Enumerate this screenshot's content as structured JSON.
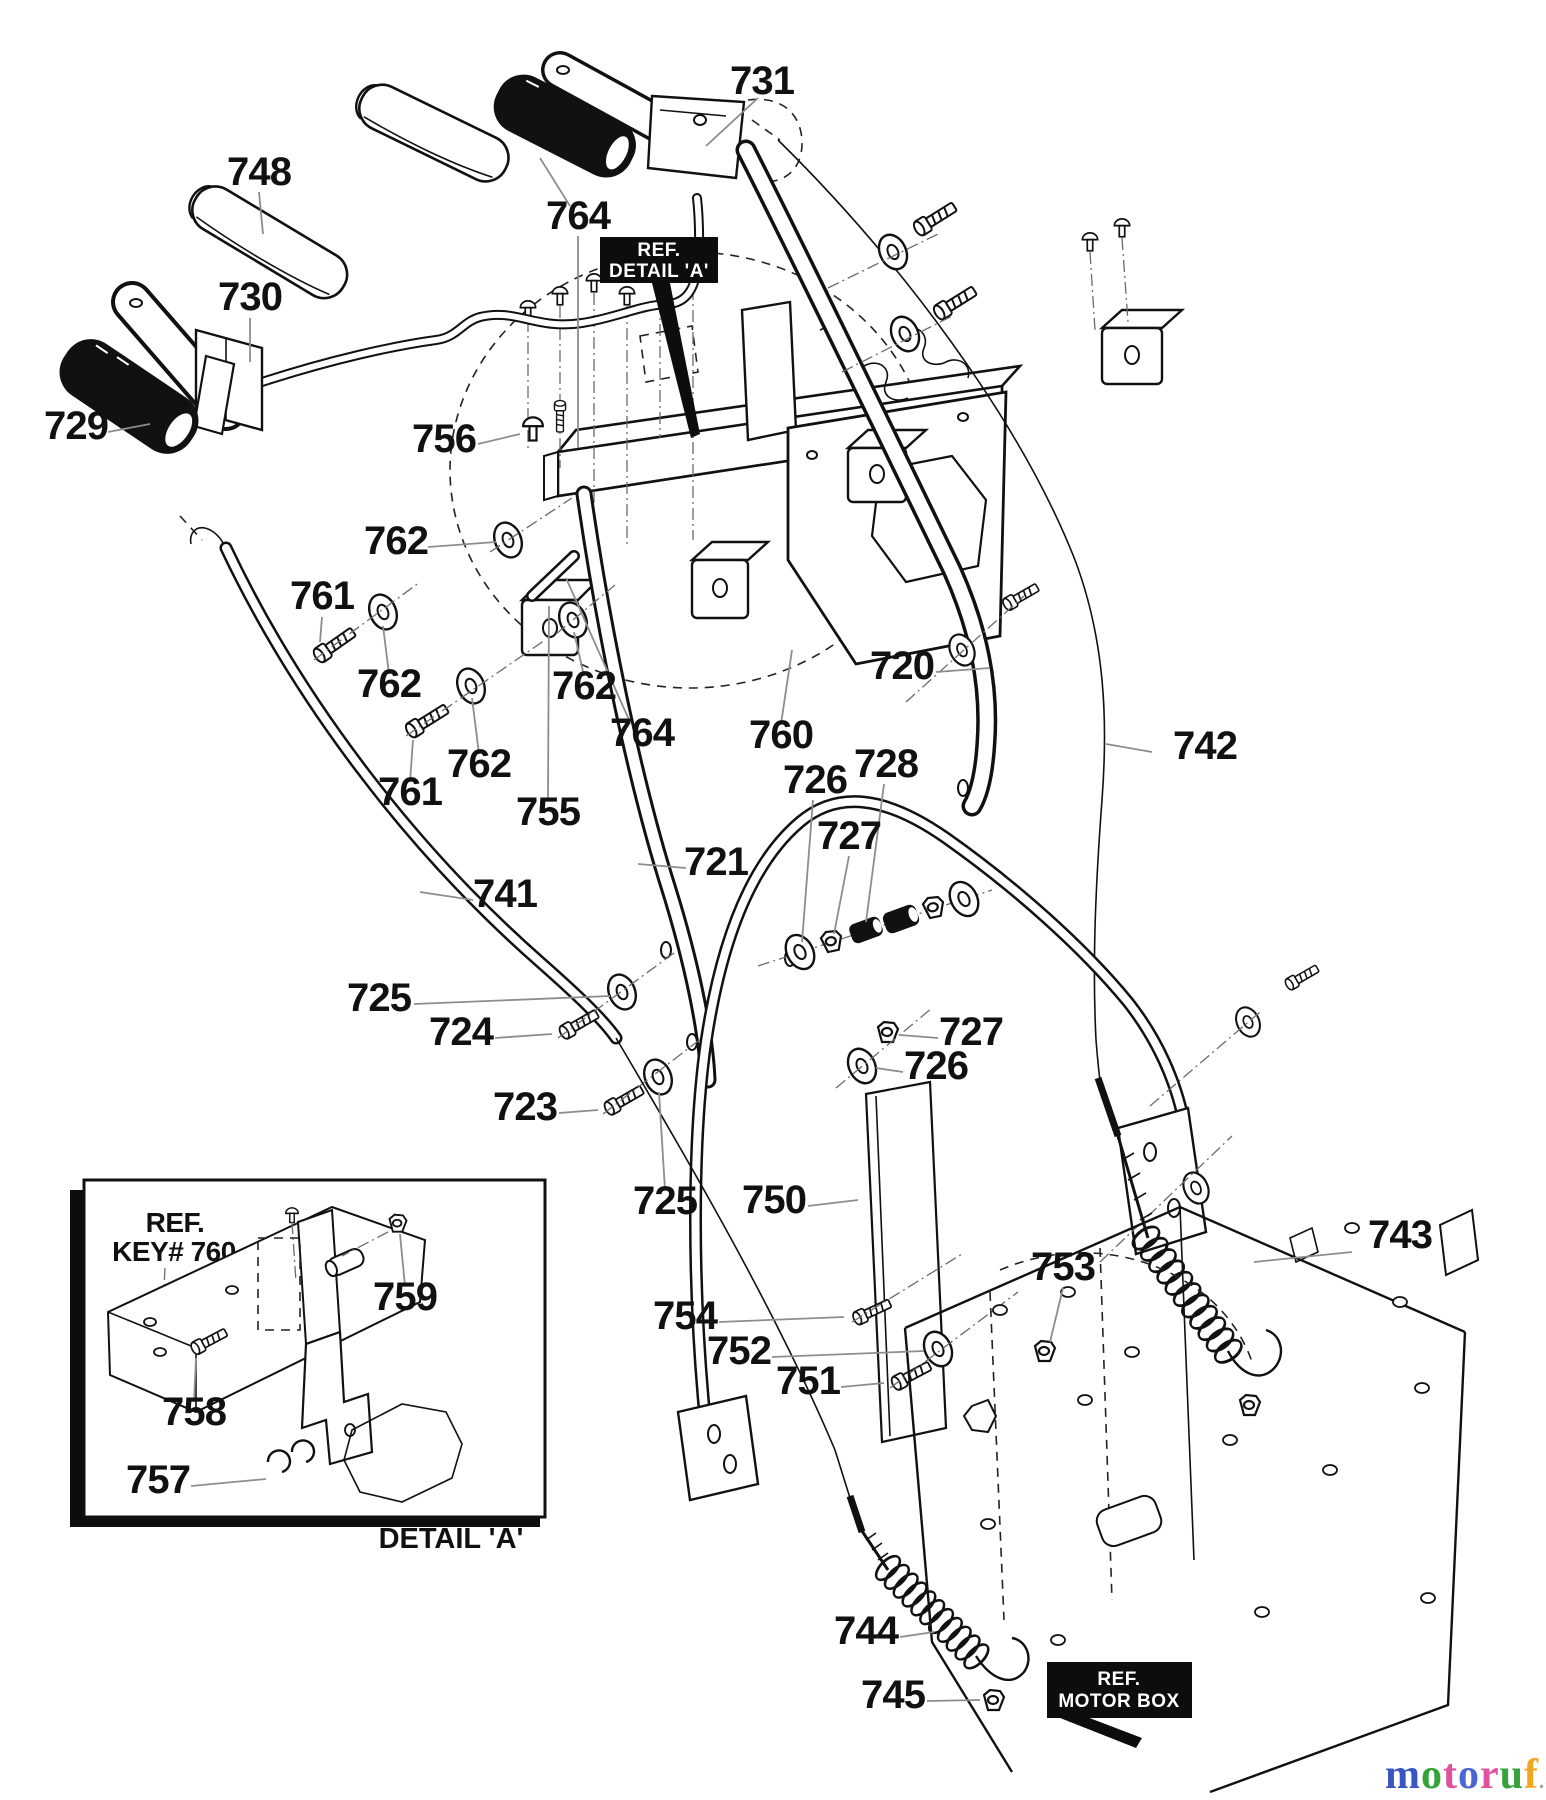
{
  "diagram": {
    "callouts": [
      {
        "part": "731"
      },
      {
        "part": "748"
      },
      {
        "part": "764"
      },
      {
        "part": "730"
      },
      {
        "part": "729"
      },
      {
        "part": "756"
      },
      {
        "part": "762"
      },
      {
        "part": "761"
      },
      {
        "part": "762"
      },
      {
        "part": "762"
      },
      {
        "part": "761"
      },
      {
        "part": "762"
      },
      {
        "part": "764"
      },
      {
        "part": "760"
      },
      {
        "part": "755"
      },
      {
        "part": "720"
      },
      {
        "part": "742"
      },
      {
        "part": "726"
      },
      {
        "part": "728"
      },
      {
        "part": "727"
      },
      {
        "part": "721"
      },
      {
        "part": "741"
      },
      {
        "part": "725"
      },
      {
        "part": "724"
      },
      {
        "part": "727"
      },
      {
        "part": "726"
      },
      {
        "part": "723"
      },
      {
        "part": "725"
      },
      {
        "part": "750"
      },
      {
        "part": "743"
      },
      {
        "part": "753"
      },
      {
        "part": "754"
      },
      {
        "part": "752"
      },
      {
        "part": "751"
      },
      {
        "part": "744"
      },
      {
        "part": "745"
      },
      {
        "part": "759"
      },
      {
        "part": "758"
      },
      {
        "part": "757"
      }
    ],
    "ref_boxes": {
      "detail_a": {
        "line1": "REF.",
        "line2": "DETAIL 'A'"
      },
      "motor_box": {
        "line1": "REF.",
        "line2": "MOTOR BOX"
      }
    },
    "inset": {
      "ref_line1": "REF.",
      "ref_line2": "KEY# 760",
      "caption": "DETAIL 'A'"
    },
    "watermark": {
      "letters": [
        {
          "ch": "m",
          "color": "#3a55c0"
        },
        {
          "ch": "o",
          "color": "#35a23c"
        },
        {
          "ch": "t",
          "color": "#e0519f"
        },
        {
          "ch": "o",
          "color": "#4a66d0"
        },
        {
          "ch": "r",
          "color": "#e0519f"
        },
        {
          "ch": "u",
          "color": "#35a23c"
        },
        {
          "ch": "f",
          "color": "#f2a71f"
        }
      ],
      "suffix": ".de",
      "suffix_color": "#9b9b9b"
    }
  }
}
